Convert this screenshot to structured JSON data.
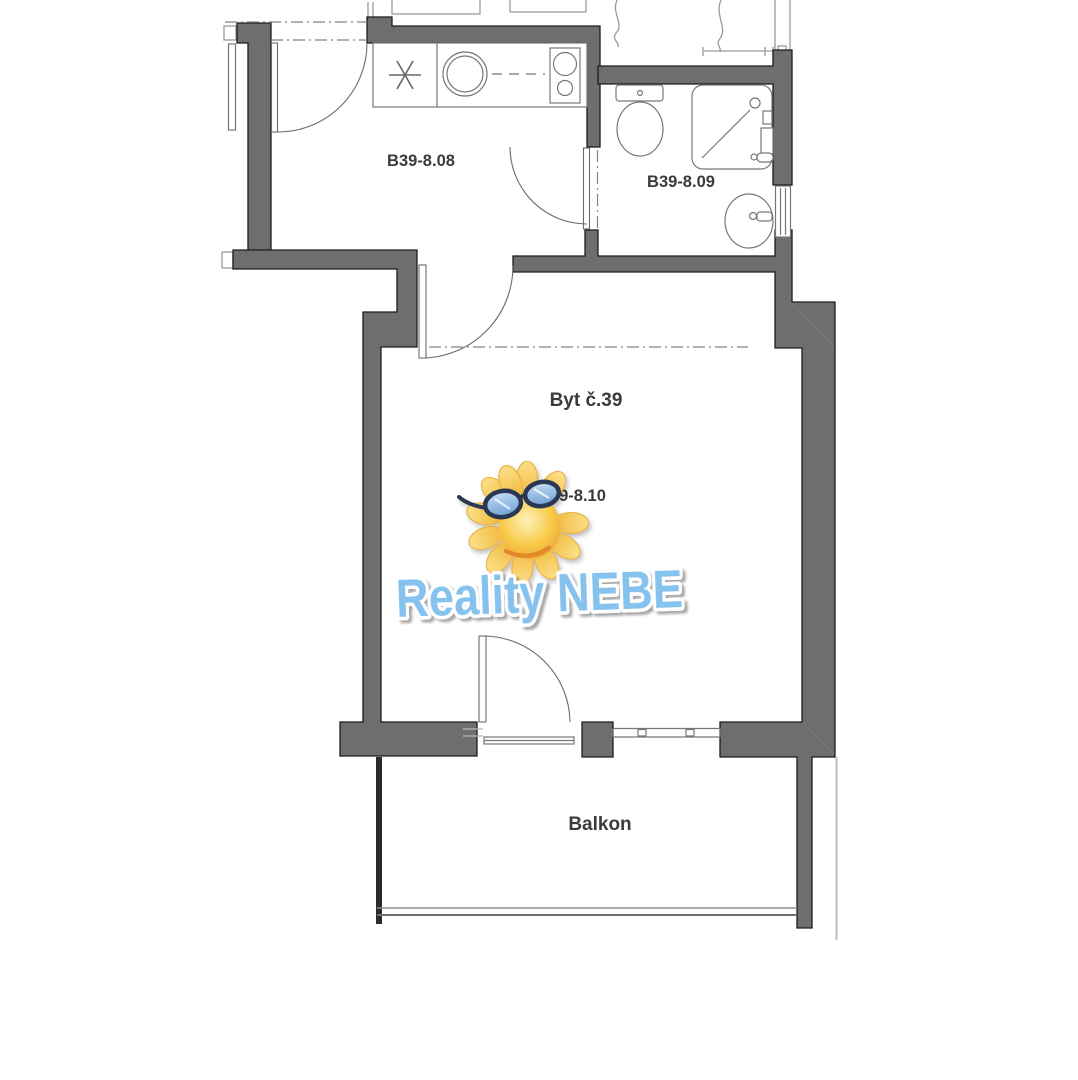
{
  "floorplan": {
    "labels": {
      "kitchen": "B39-8.08",
      "bathroom": "B39-8.09",
      "apartment": "Byt č.39",
      "room": "B39-8.10",
      "balcony": "Balkon"
    },
    "watermark": {
      "brand": "Reality NEBE",
      "icon": "sun-with-sunglasses-icon"
    },
    "colors": {
      "wall_fill": "#6e6e6e",
      "wall_edge": "#1c1c1c",
      "fixture_line": "#777777",
      "label_text": "#3b3b3b",
      "brand_blue": "#85c2ee",
      "sun_yellow": "#f8cf4e"
    }
  }
}
